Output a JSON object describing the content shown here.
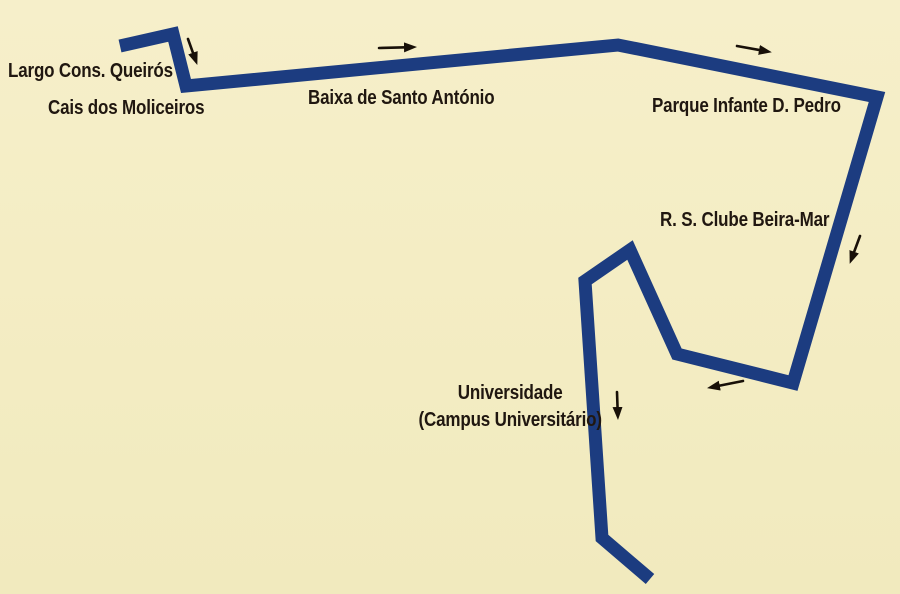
{
  "figure": {
    "type": "route-map"
  },
  "colors": {
    "background": "#f4edc4",
    "route_line": "#1c3c80",
    "arrow": "#181008",
    "label_text": "#201710"
  },
  "route": {
    "points_str": "120,46 173,34 186,86 618,45 877,97 793,383 677,354 630,250 585,281 602,538 650,579",
    "stroke_width": "13"
  },
  "stops": [
    {
      "name": "Largo Cons. Queirós"
    },
    {
      "name": "Cais dos Moliceiros"
    },
    {
      "name": "Baixa de Santo António"
    },
    {
      "name": "Parque Infante D. Pedro"
    },
    {
      "name": "R. S. Clube Beira-Mar"
    },
    {
      "name": "Universidade",
      "sub": "(Campus Universitário)"
    }
  ],
  "arrows": [
    {
      "direction": "down",
      "near": "Largo Cons. Queirós"
    },
    {
      "direction": "right",
      "near": "Baixa de Santo António"
    },
    {
      "direction": "right",
      "near": "Parque Infante D. Pedro"
    },
    {
      "direction": "down",
      "near": "R. S. Clube Beira-Mar"
    },
    {
      "direction": "left",
      "near": "Universidade loop"
    },
    {
      "direction": "down",
      "near": "Universidade"
    }
  ]
}
